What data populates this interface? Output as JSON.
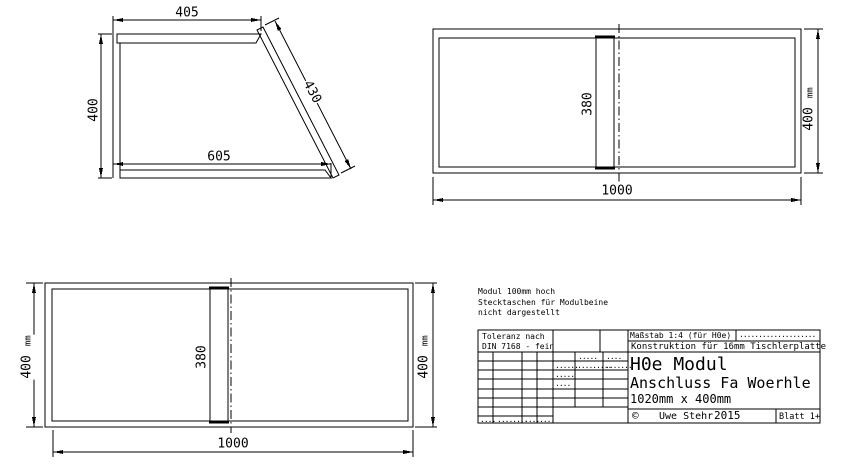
{
  "colors": {
    "line": "#000000",
    "background": "#ffffff"
  },
  "trapezoid_view": {
    "dim_top": "405",
    "dim_left": "400",
    "dim_bottom": "605",
    "dim_diagonal": "430"
  },
  "module_top_view": {
    "dim_width": "1000",
    "dim_divider": "380",
    "dim_height": "400",
    "dim_height_unit": "mm"
  },
  "module_bottom_view": {
    "dim_width": "1000",
    "dim_divider": "380",
    "dim_height_left": "400",
    "dim_height_left_unit": "mm",
    "dim_height_right": "400",
    "dim_height_right_unit": "mm"
  },
  "note": {
    "line1": "Modul 100mm hoch",
    "line2": "Stecktaschen für Modulbeine",
    "line3": "nicht dargestellt"
  },
  "title_block": {
    "tolerance1": "Toleranz nach",
    "tolerance2": "DIN 7168 - fein",
    "scale": "Maßstab 1:4  (für H0e)",
    "scale_dots": "····················",
    "construction": "Konstruktion für 16mm Tischlerplatte",
    "product": "H0e Modul",
    "subtitle": "Anschluss Fa Woerhle",
    "dimensions": "1020mm x 400mm",
    "copyright": "©",
    "author": "Uwe Stehr",
    "year": "2015",
    "sheet": "Blatt 1+",
    "grid_dots": {
      "r1c2": "·····",
      "r1c3": "····",
      "r2c1": "······",
      "r2c2": "·········",
      "r2c3": "·······",
      "r3c1": "·····",
      "r4c1": "····",
      "b1": "····",
      "b2": "········",
      "b3": "····",
      "b4": "····"
    }
  }
}
